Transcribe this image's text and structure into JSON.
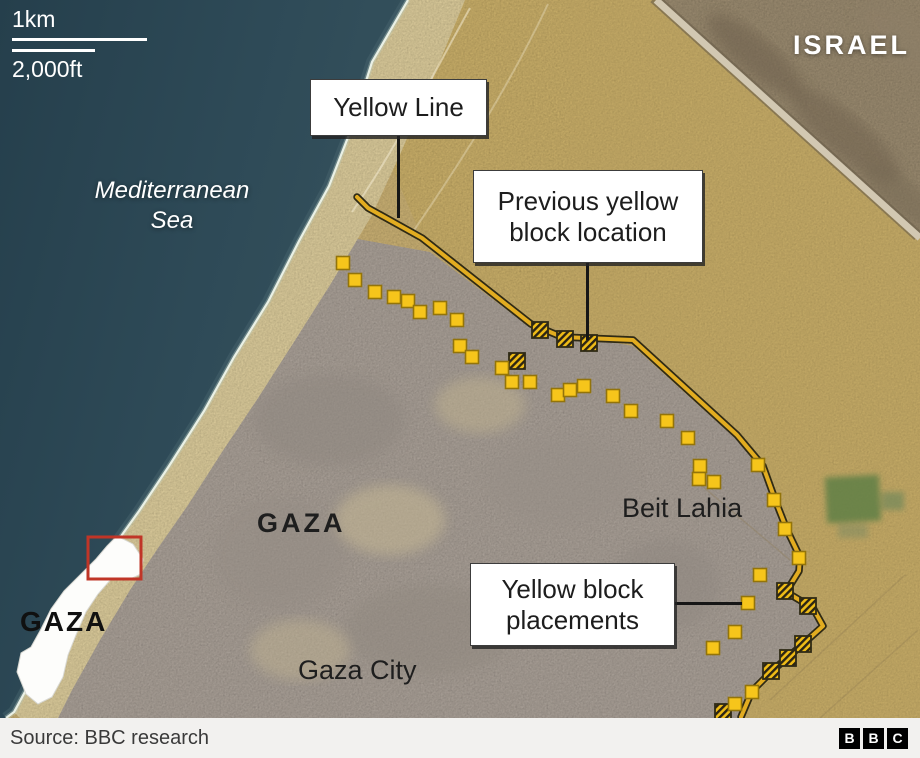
{
  "colors": {
    "sea": "#2d4854",
    "sand": "#d7bc7b",
    "beach": "#ead9a6",
    "urban": "#b5aba2",
    "israel_terrain": "#a59478",
    "yellow_line": "#e2ac20",
    "yellow_line_outline": "#2f2a15",
    "block_fill": "#f6c51b",
    "block_border": "#93740a",
    "hatch_stripe": "#2b2414",
    "red_box": "#c03527",
    "label_box_bg": "#ffffff",
    "footer_bg": "#f2f1ef"
  },
  "scale_bar": {
    "metric": "1km",
    "imperial": "2,000ft"
  },
  "labels": {
    "israel": "ISRAEL",
    "sea_line1": "Mediterranean",
    "sea_line2": "Sea",
    "gaza_region": "GAZA",
    "beit_lahia": "Beit Lahia",
    "gaza_city": "Gaza City",
    "gaza_inset": "GAZA"
  },
  "callouts": {
    "yellow_line": "Yellow Line",
    "previous_block": "Previous yellow block location",
    "placements": "Yellow block placements"
  },
  "footer": {
    "source": "Source: BBC research",
    "logo": [
      "B",
      "B",
      "C"
    ]
  },
  "map_data": {
    "yellow_line_path": [
      [
        357,
        197
      ],
      [
        368,
        208
      ],
      [
        422,
        238
      ],
      [
        531,
        324
      ],
      [
        562,
        337
      ],
      [
        633,
        340
      ],
      [
        737,
        435
      ],
      [
        763,
        466
      ],
      [
        776,
        502
      ],
      [
        787,
        530
      ],
      [
        800,
        557
      ],
      [
        799,
        571
      ],
      [
        786,
        592
      ],
      [
        813,
        608
      ],
      [
        823,
        626
      ],
      [
        803,
        644
      ],
      [
        772,
        671
      ],
      [
        752,
        691
      ],
      [
        741,
        717
      ]
    ],
    "solid_blocks": [
      [
        343,
        263
      ],
      [
        355,
        280
      ],
      [
        375,
        292
      ],
      [
        394,
        297
      ],
      [
        408,
        301
      ],
      [
        420,
        312
      ],
      [
        440,
        308
      ],
      [
        457,
        320
      ],
      [
        460,
        346
      ],
      [
        472,
        357
      ],
      [
        502,
        368
      ],
      [
        512,
        382
      ],
      [
        530,
        382
      ],
      [
        558,
        395
      ],
      [
        570,
        390
      ],
      [
        584,
        386
      ],
      [
        613,
        396
      ],
      [
        631,
        411
      ],
      [
        667,
        421
      ],
      [
        688,
        438
      ],
      [
        700,
        466
      ],
      [
        699,
        479
      ],
      [
        714,
        482
      ],
      [
        758,
        465
      ],
      [
        774,
        500
      ],
      [
        785,
        529
      ],
      [
        799,
        558
      ],
      [
        760,
        575
      ],
      [
        748,
        603
      ],
      [
        735,
        632
      ],
      [
        713,
        648
      ],
      [
        752,
        692
      ],
      [
        735,
        704
      ]
    ],
    "hatched_blocks": [
      [
        540,
        330
      ],
      [
        565,
        339
      ],
      [
        589,
        343
      ],
      [
        517,
        361
      ],
      [
        785,
        591
      ],
      [
        808,
        606
      ],
      [
        803,
        644
      ],
      [
        788,
        658
      ],
      [
        771,
        671
      ],
      [
        723,
        712
      ]
    ],
    "block_size": 13,
    "hatched_size": 16,
    "red_rect": {
      "x": 88,
      "y": 537,
      "w": 53,
      "h": 42
    }
  }
}
